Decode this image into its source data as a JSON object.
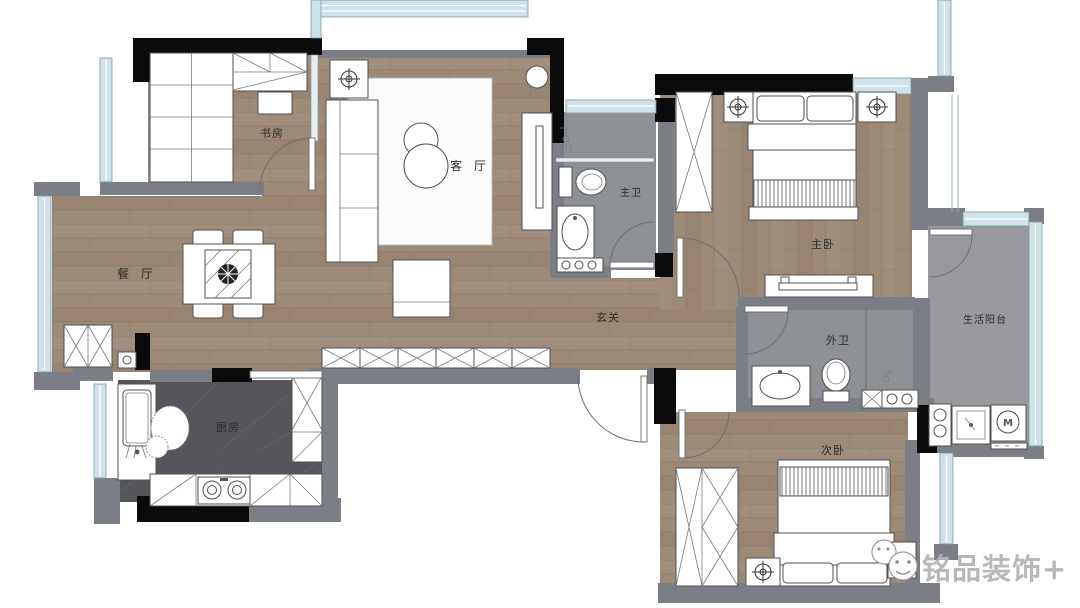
{
  "floorplan": {
    "type": "residential-floor-plan",
    "labels": {
      "study": "书房",
      "living": "客 厅",
      "dining": "餐 厅",
      "kitchen": "厨房",
      "hall": "玄关",
      "master_bath": "主卫",
      "master_bed": "主卧",
      "guest_bath": "外卫",
      "service_balcony": "生活阳台",
      "second_bed": "次卧"
    },
    "appliances": {
      "washer_mark": "M"
    },
    "watermark": {
      "text": "铭品装饰+"
    },
    "colors": {
      "wood_floor": "#9c8a79",
      "wall": "#7b7f85",
      "structural_column": "#0b0b0b",
      "window": "#cfe1e9",
      "kitchen_floor": "#55565b",
      "bath_floor": "#8d9095",
      "balcony_floor": "#97999d",
      "furniture": "#ffffff",
      "outline": "#4f4f4f"
    }
  }
}
